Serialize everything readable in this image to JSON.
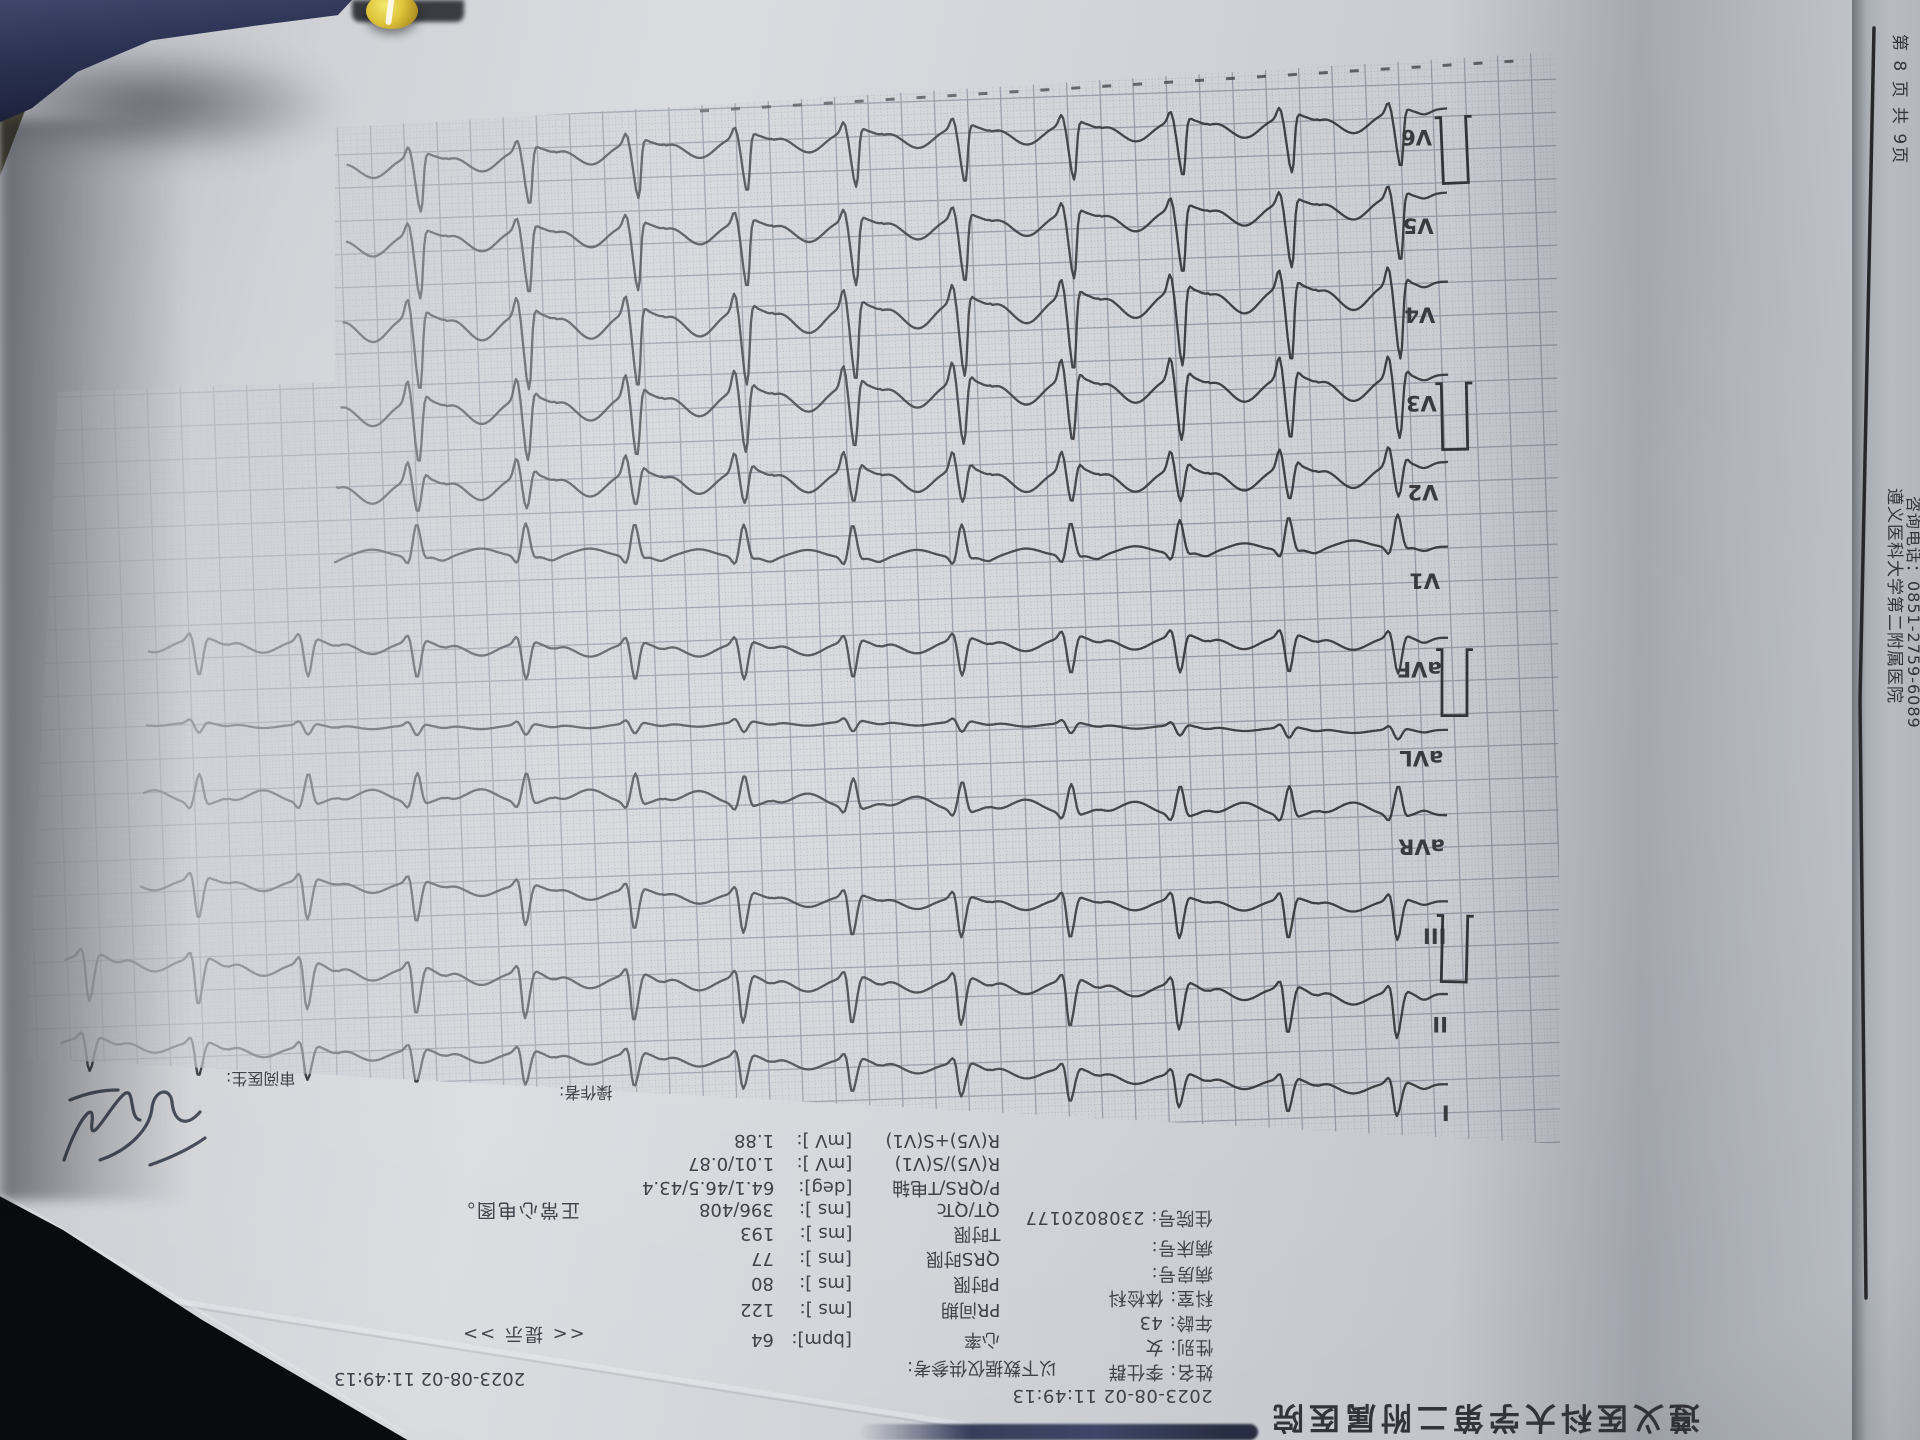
{
  "hospital": "遵义医科大学第二附属医院",
  "page_info": "第 8 页 共 9页",
  "phone": "咨询电话：0851-2759-6089",
  "datetime": "2023-08-02 11:49:13",
  "patient": {
    "lines": [
      {
        "label": "",
        "value": "2023-08-02 11:49:13"
      },
      {
        "label": "姓名:",
        "value": "李仕群"
      },
      {
        "label": "性别:",
        "value": "女"
      },
      {
        "label": "年龄:",
        "value": "43"
      },
      {
        "label": "科室:",
        "value": "体检科"
      },
      {
        "label": "病房号:",
        "value": ""
      },
      {
        "label": "病床号:",
        "value": ""
      },
      {
        "label": "住院号:",
        "value": "2308020177"
      }
    ]
  },
  "measurements": {
    "note": "以下数据仅供参考:",
    "items": [
      {
        "label": "心率",
        "unit": "[bpm]:",
        "value": "64"
      },
      {
        "label": "PR间期",
        "unit": "[ms ]:",
        "value": "122"
      },
      {
        "label": "P时限",
        "unit": "[ms ]:",
        "value": "80"
      },
      {
        "label": "QRS时限",
        "unit": "[ms ]:",
        "value": "77"
      },
      {
        "label": "T时限",
        "unit": "[ms ]:",
        "value": "193"
      },
      {
        "label": "QT/QTc",
        "unit": "[ms ]:",
        "value": "396/408"
      },
      {
        "label": "P/QRS/T电轴",
        "unit": "[deg]:",
        "value": "64.1/46.5/43.4"
      },
      {
        "label": "R(V5)/S(V1)",
        "unit": "[mV ]:",
        "value": "1.01/0.87"
      },
      {
        "label": "R(V5)+S(V1)",
        "unit": "[mV ]:",
        "value": "1.88"
      }
    ]
  },
  "diagnosis": {
    "hint": "<< 提示 >>",
    "conclusion": "正常心电图。"
  },
  "staff": {
    "operator_label": "操作者:",
    "reviewer_label": "审阅医生:"
  },
  "colors": {
    "paper": "#cdd0d5",
    "grid_major": "#8e93a0",
    "grid_dot": "#a0a3af",
    "trace": "#33343a",
    "navy_object": "#2a3152",
    "yellow_bead": "#ddc23a",
    "second_sheet": "#b3b7bd",
    "table_dark": "#0a0b0e"
  },
  "chart_data": {
    "type": "line",
    "kind": "12-lead ECG, printout photographed upside down",
    "title": "正常心电图。",
    "heart_rate_bpm": 64,
    "beat_interval_px": 109,
    "row_pitch_px": 88.7,
    "mv_scale_px": 66,
    "calibration_mark_rows": [
      0,
      3,
      6,
      9
    ],
    "leads_top_to_bottom": [
      "V6",
      "V5",
      "V4",
      "V3",
      "V2",
      "V1",
      "aVF",
      "aVL",
      "aVR",
      "III",
      "II",
      "I"
    ],
    "leads": [
      {
        "name": "V6",
        "end_x": 345,
        "r": 0.85,
        "s": 0.18,
        "t": 0.3,
        "p": 0.07
      },
      {
        "name": "V5",
        "end_x": 345,
        "r": 1.0,
        "s": 0.2,
        "t": 0.33,
        "p": 0.07
      },
      {
        "name": "V4",
        "end_x": 342,
        "r": 1.15,
        "s": 0.3,
        "t": 0.4,
        "p": 0.08
      },
      {
        "name": "V3",
        "end_x": 340,
        "r": 0.95,
        "s": 0.35,
        "t": 0.38,
        "p": 0.08
      },
      {
        "name": "V2",
        "end_x": 336,
        "r": 0.5,
        "s": 0.3,
        "t": 0.35,
        "p": 0.08
      },
      {
        "name": "V1",
        "end_x": 334,
        "r": -0.5,
        "s": 0.12,
        "t": -0.12,
        "p": 0.06
      },
      {
        "name": "aVF",
        "end_x": 148,
        "r": 0.55,
        "s": 0.12,
        "t": 0.2,
        "p": 0.08
      },
      {
        "name": "aVL",
        "end_x": 146,
        "r": 0.15,
        "s": 0.06,
        "t": 0.06,
        "p": 0.04
      },
      {
        "name": "aVR",
        "end_x": 143,
        "r": -0.45,
        "s": 0.1,
        "t": -0.2,
        "p": -0.07
      },
      {
        "name": "III",
        "end_x": 140,
        "r": 0.6,
        "s": 0.12,
        "t": 0.18,
        "p": 0.06
      },
      {
        "name": "II",
        "end_x": 64,
        "r": 0.7,
        "s": 0.12,
        "t": 0.22,
        "p": 0.1
      },
      {
        "name": "I",
        "end_x": 60,
        "r": 0.5,
        "s": 0.1,
        "t": 0.18,
        "p": 0.08
      }
    ]
  }
}
